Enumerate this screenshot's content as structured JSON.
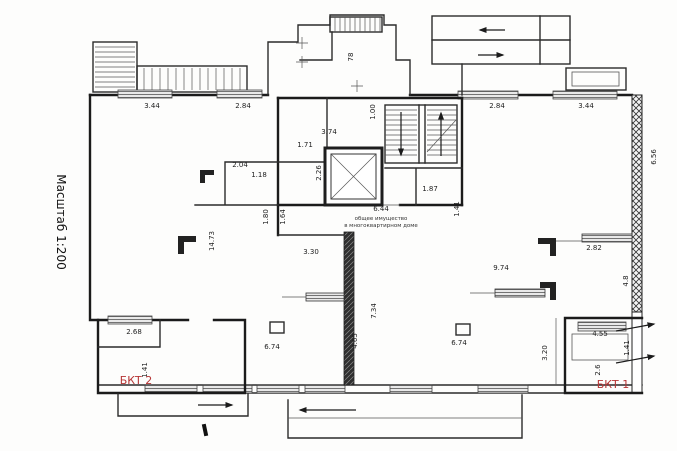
{
  "scale_label": "Масштаб 1:200",
  "center_note": {
    "dim": "6.44",
    "line1": "общее имущество",
    "line2": "в многоквартирном доме"
  },
  "red_labels": [
    {
      "text": "БКТ 2",
      "x": 136,
      "y": 384
    },
    {
      "text": "БКТ 1",
      "x": 613,
      "y": 388
    }
  ],
  "annotations": [
    {
      "text": "3.44",
      "x": 152,
      "y": 108,
      "rot": 0
    },
    {
      "text": "2.84",
      "x": 243,
      "y": 108,
      "rot": 0
    },
    {
      "text": "2.84",
      "x": 497,
      "y": 108,
      "rot": 0
    },
    {
      "text": "3.44",
      "x": 586,
      "y": 108,
      "rot": 0
    },
    {
      "text": "78",
      "x": 353,
      "y": 57,
      "rot": -90
    },
    {
      "text": "1.00",
      "x": 375,
      "y": 112,
      "rot": -90
    },
    {
      "text": "3.74",
      "x": 329,
      "y": 134,
      "rot": 0
    },
    {
      "text": "1.71",
      "x": 305,
      "y": 147,
      "rot": 0
    },
    {
      "text": "2.04",
      "x": 240,
      "y": 167,
      "rot": 0
    },
    {
      "text": "1.18",
      "x": 259,
      "y": 177,
      "rot": 0
    },
    {
      "text": "2.26",
      "x": 321,
      "y": 173,
      "rot": -90
    },
    {
      "text": "1.87",
      "x": 430,
      "y": 191,
      "rot": 0
    },
    {
      "text": "1.41",
      "x": 459,
      "y": 209,
      "rot": -90
    },
    {
      "text": "1.80",
      "x": 268,
      "y": 217,
      "rot": -90
    },
    {
      "text": "1.64",
      "x": 285,
      "y": 217,
      "rot": -90
    },
    {
      "text": "3.30",
      "x": 311,
      "y": 254,
      "rot": 0
    },
    {
      "text": "14.73",
      "x": 214,
      "y": 241,
      "rot": -90
    },
    {
      "text": "9.74",
      "x": 501,
      "y": 270,
      "rot": 0
    },
    {
      "text": "2.82",
      "x": 594,
      "y": 250,
      "rot": 0
    },
    {
      "text": "4.8",
      "x": 628,
      "y": 281,
      "rot": -90
    },
    {
      "text": "6.56",
      "x": 656,
      "y": 157,
      "rot": -90
    },
    {
      "text": "7.34",
      "x": 376,
      "y": 311,
      "rot": -90
    },
    {
      "text": "4.65",
      "x": 357,
      "y": 341,
      "rot": -90
    },
    {
      "text": "6.74",
      "x": 272,
      "y": 349,
      "rot": 0
    },
    {
      "text": "6.74",
      "x": 459,
      "y": 345,
      "rot": 0
    },
    {
      "text": "2.68",
      "x": 134,
      "y": 334,
      "rot": 0
    },
    {
      "text": "1.41",
      "x": 147,
      "y": 370,
      "rot": -90
    },
    {
      "text": "4.55",
      "x": 600,
      "y": 336,
      "rot": 0
    },
    {
      "text": "1.41",
      "x": 629,
      "y": 348,
      "rot": -90
    },
    {
      "text": "3.20",
      "x": 547,
      "y": 353,
      "rot": -90
    },
    {
      "text": "2.6",
      "x": 600,
      "y": 370,
      "rot": -90
    }
  ],
  "colors": {
    "line": "#1b1b1b",
    "red": "#b63535",
    "window_fill": "#e9e9e9"
  }
}
